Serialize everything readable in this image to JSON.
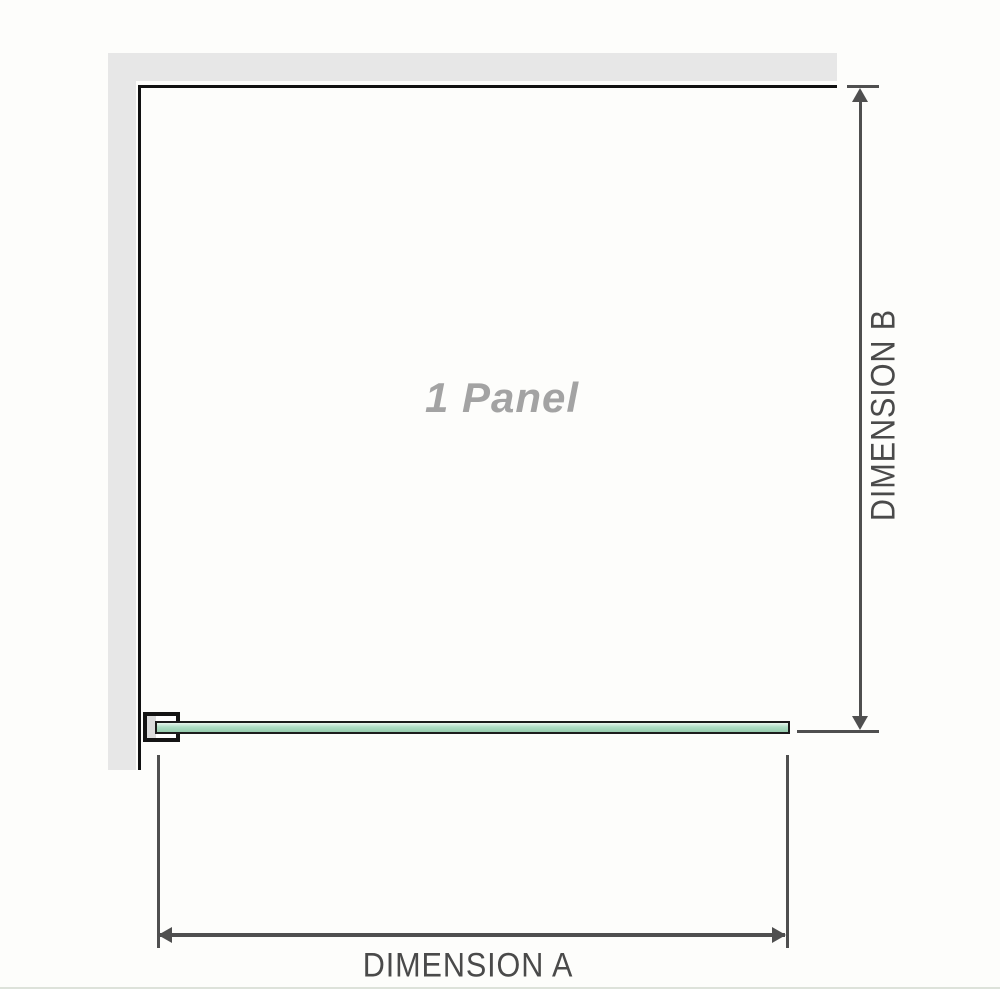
{
  "diagram": {
    "panel_label": "1 Panel",
    "dimension_a": {
      "label": "DIMENSION A"
    },
    "dimension_b": {
      "label": "DIMENSION B"
    }
  },
  "colors": {
    "wall": "#e7e7e7",
    "panel-border": "#111111",
    "panel-text": "#a3a3a3",
    "glass-light": "#e9f6ee",
    "glass-mid": "#aeddc4",
    "glass-dark": "#97ccae",
    "glass-border": "#1c1c1c",
    "bracket-border": "#141414",
    "bracket-pad": "#dcdcdc",
    "dim-line": "#4f4f4f",
    "dim-text": "#4a4a4a",
    "page-edge": "#dde2da"
  }
}
